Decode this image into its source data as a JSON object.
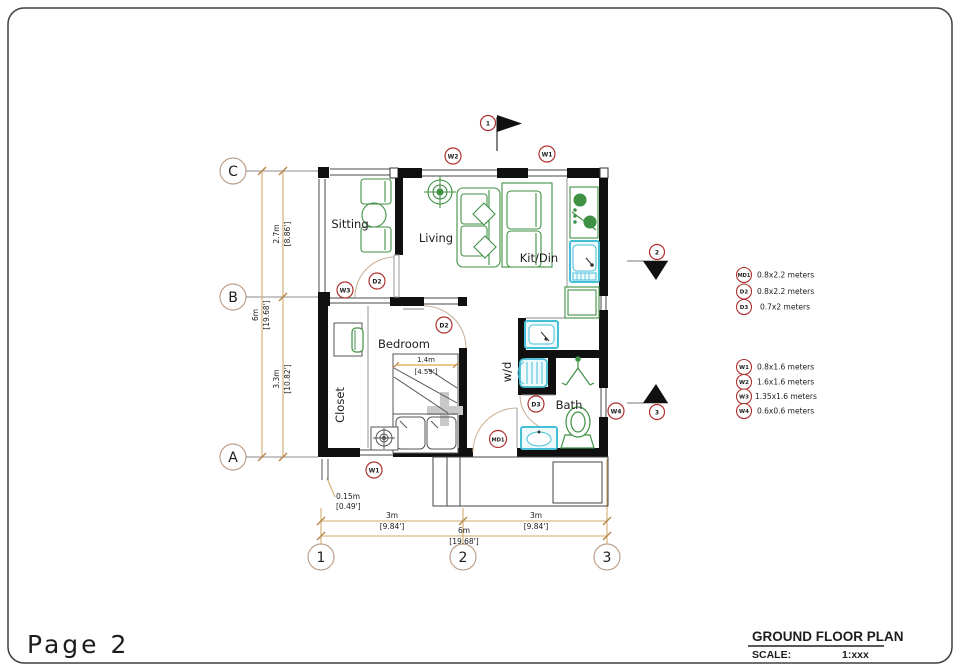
{
  "page": {
    "label": "Page 2"
  },
  "title_block": {
    "title": "GROUND FLOOR PLAN",
    "scale_label": "SCALE:",
    "scale_value": "1:xxx"
  },
  "rooms": {
    "sitting": "Sitting",
    "living": "Living",
    "kitdin": "Kit/Din",
    "bedroom": "Bedroom",
    "closet": "Closet",
    "wd": "w/d",
    "bath": "Bath"
  },
  "grid": {
    "row_c": "C",
    "row_b": "B",
    "row_a": "A",
    "col_1": "1",
    "col_2": "2",
    "col_3": "3"
  },
  "north": {
    "label": "1"
  },
  "sections": {
    "s2": "2",
    "s3": "3"
  },
  "tags": {
    "w2_top": "W2",
    "w1_top": "W1",
    "w3": "W3",
    "w4": "W4",
    "d2_sitting": "D2",
    "d2_bedroom": "D2",
    "d3": "D3",
    "md1": "MD1",
    "w1_bottom": "W1"
  },
  "dims": {
    "left_total_m": "6m",
    "left_total_ft": "[19.68']",
    "left_upper_m": "2.7m",
    "left_upper_ft": "[8.86']",
    "left_lower_m": "3.3m",
    "left_lower_ft": "[10.82']",
    "bottom_left_m": "3m",
    "bottom_left_ft": "[9.84']",
    "bottom_right_m": "3m",
    "bottom_right_ft": "[9.84']",
    "bottom_total_m": "6m",
    "bottom_total_ft": "[19.68']",
    "offset_m": "0.15m",
    "offset_ft": "[0.49']",
    "bed_m": "1.4m",
    "bed_ft": "[4.59']"
  },
  "legend": {
    "doors": [
      {
        "tag": "MD1",
        "size": "0.8x2.2  meters"
      },
      {
        "tag": "D2",
        "size": "0.8x2.2  meters"
      },
      {
        "tag": "D3",
        "size": "0.7x2  meters"
      }
    ],
    "windows": [
      {
        "tag": "W1",
        "size": "0.8x1.6  meters"
      },
      {
        "tag": "W2",
        "size": "1.6x1.6  meters"
      },
      {
        "tag": "W3",
        "size": "1.35x1.6  meters"
      },
      {
        "tag": "W4",
        "size": "0.6x0.6  meters"
      }
    ]
  },
  "colors": {
    "wall": "#101010",
    "furniture_green": "#3f9144",
    "plumbing_cyan": "#45bfd6",
    "dimension_tan": "#cfa468",
    "marker_red": "#b03030",
    "grid_circle": "#bfa18b",
    "page_label_gray": "#8c8c8c"
  }
}
